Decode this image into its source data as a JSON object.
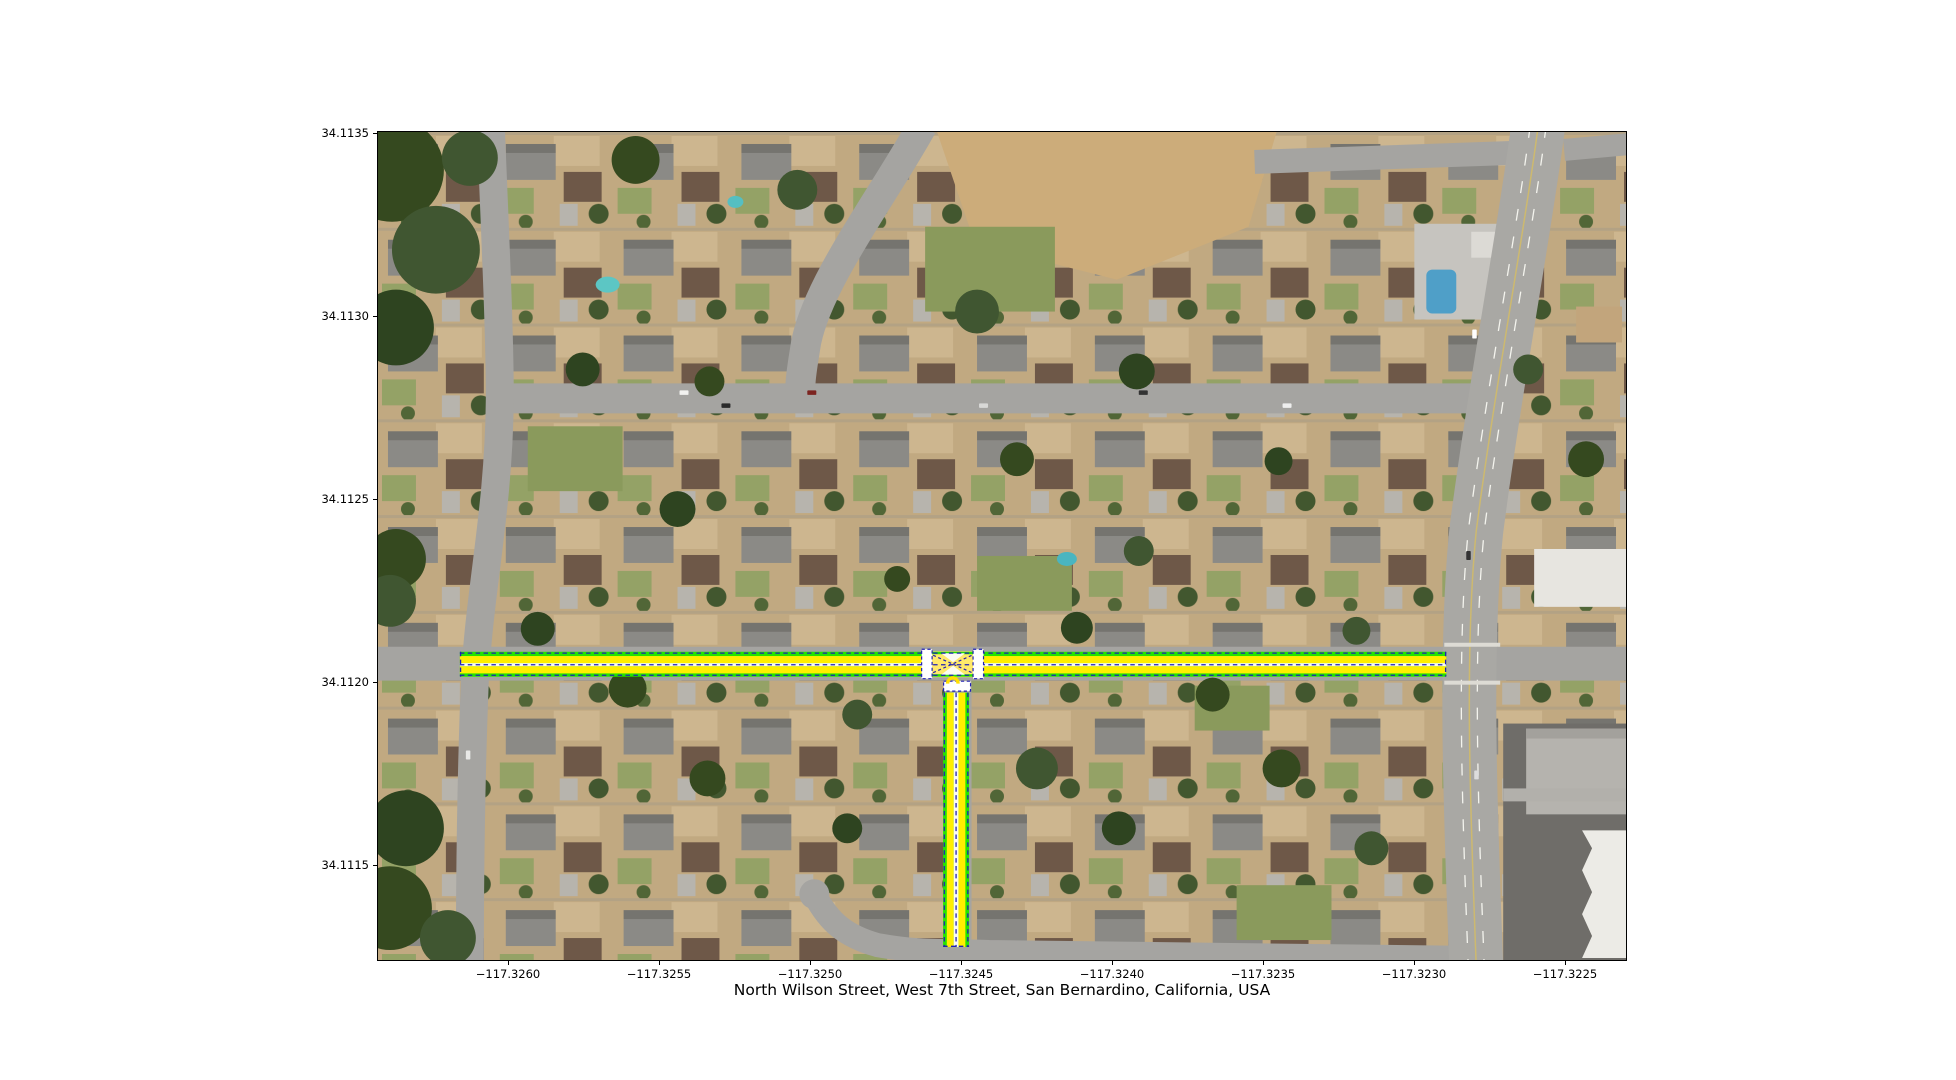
{
  "figure": {
    "background": "#ffffff"
  },
  "title": {
    "text": "North Wilson Street, West 7th Street, San Bernardino, California, USA"
  },
  "axes": {
    "x_tick_labels": [
      "−117.3260",
      "−117.3255",
      "−117.3250",
      "−117.3245",
      "−117.3240",
      "−117.3235",
      "−117.3230",
      "−117.3225"
    ],
    "y_tick_labels": [
      "34.1135",
      "34.1130",
      "34.1125",
      "34.1120",
      "34.1115"
    ]
  },
  "map": {
    "basemap": "aerial-satellite-imagery",
    "location": "San Bernardino, California, USA",
    "highlighted_streets": [
      "West 7th Street",
      "North Wilson Street"
    ],
    "overlay_colors": {
      "lane_boundary_green": "#24e400",
      "lane_fill_yellow": "#ffee00",
      "centerline_navy_dash": "#2020b4",
      "junction_white": "#ffffff"
    }
  }
}
